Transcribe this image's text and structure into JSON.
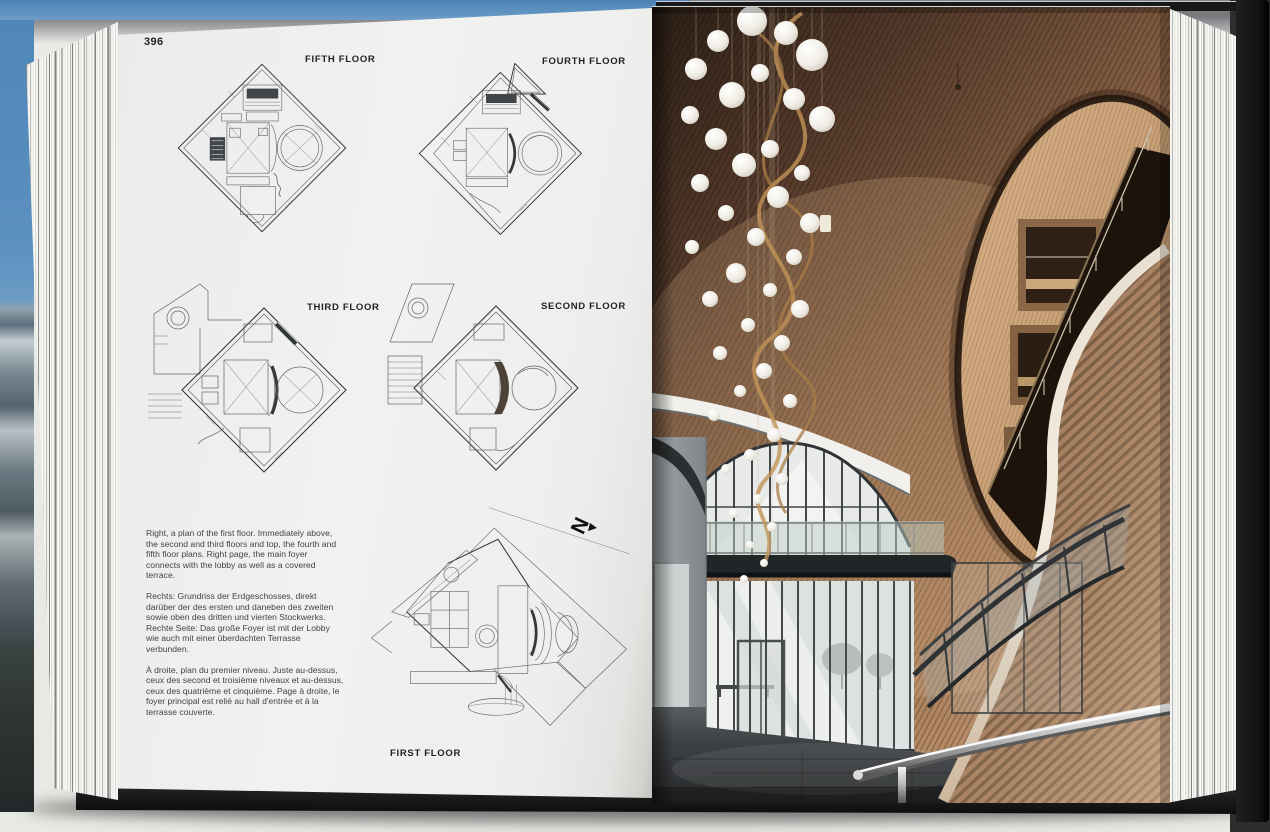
{
  "page": {
    "number": "396"
  },
  "plans": [
    {
      "id": "fifth-floor",
      "label": "FIFTH FLOOR"
    },
    {
      "id": "fourth-floor",
      "label": "FOURTH FLOOR"
    },
    {
      "id": "third-floor",
      "label": "THIRD FLOOR"
    },
    {
      "id": "second-floor",
      "label": "SECOND FLOOR"
    },
    {
      "id": "first-floor",
      "label": "FIRST FLOOR"
    }
  ],
  "north_arrow": "N",
  "captions": {
    "en": "Right, a plan of the first floor. Immediately above, the second and third floors and top, the fourth and fifth floor plans. Right page, the main foyer connects with the lobby as well as a covered terrace.",
    "de": "Rechts: Grundriss der Erdgeschosses, direkt darüber der des ersten und daneben des zweiten sowie oben des dritten und vierten Stockwerks. Rechte Seite: Das große Foyer ist mit der Lobby wie auch mit einer überdachten Terrasse verbunden.",
    "fr": "À droite, plan du premier niveau. Juste au-dessus, ceux des second et troisième niveaux et au-dessus, ceux des quatrième et cinquième. Page à droite, le foyer principal est relié au hall d'entrée et à la terrasse couverte."
  },
  "colors": {
    "sky": "#4b83b6",
    "cover": "#171717",
    "paper": "#f0f1ef",
    "wood_dark": "#2b1f16",
    "wood_mid": "#8a6346",
    "wood_light": "#c49a74"
  }
}
